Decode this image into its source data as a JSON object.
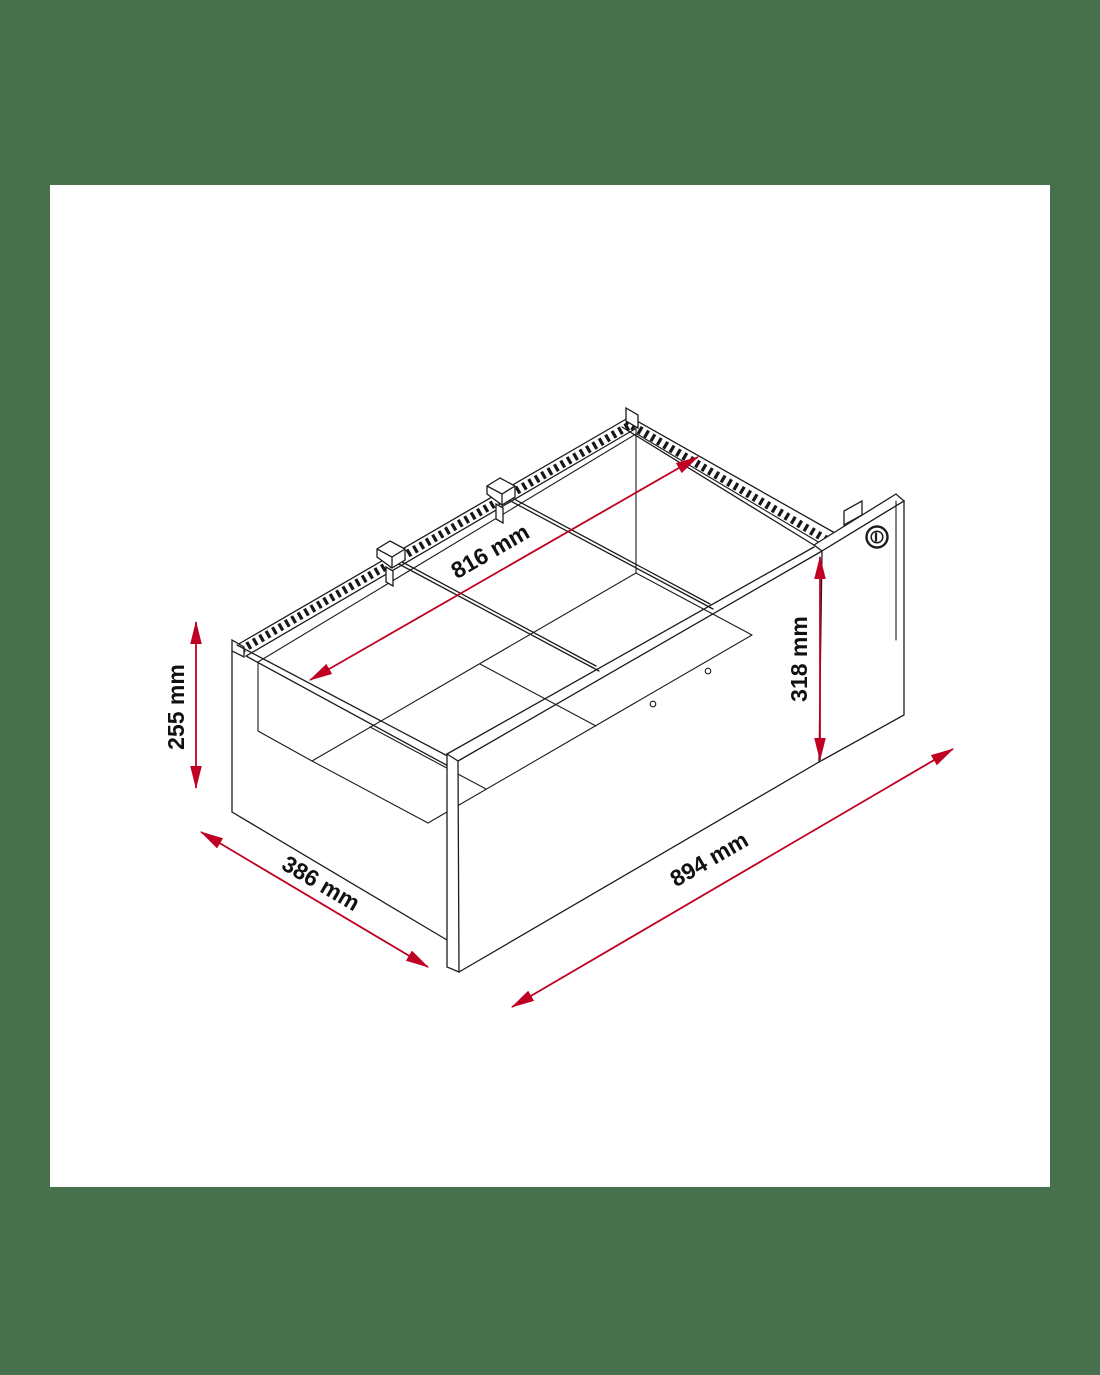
{
  "page": {
    "background_color": "#47714d",
    "canvas_color": "#ffffff"
  },
  "diagram": {
    "type": "isometric-technical-drawing",
    "subject": "lockable drawer box with two divider rails and front panel",
    "line_color": "#1c1c1c",
    "dimension_color": "#c00022",
    "parts": {
      "lock_icon": "lock-cylinder",
      "rail_clips": 2,
      "divider_rails": 2,
      "screw_holes": 2
    },
    "dimensions": [
      {
        "id": "inner-width",
        "label": "816 mm",
        "value_mm": 816,
        "orientation": "diagonal-across-top-opening"
      },
      {
        "id": "side-height",
        "label": "255 mm",
        "value_mm": 255,
        "orientation": "vertical-left"
      },
      {
        "id": "front-height",
        "label": "318 mm",
        "value_mm": 318,
        "orientation": "vertical-right"
      },
      {
        "id": "depth",
        "label": "386 mm",
        "value_mm": 386,
        "orientation": "diagonal-bottom-left"
      },
      {
        "id": "outer-width",
        "label": "894 mm",
        "value_mm": 894,
        "orientation": "diagonal-bottom-right"
      }
    ]
  }
}
